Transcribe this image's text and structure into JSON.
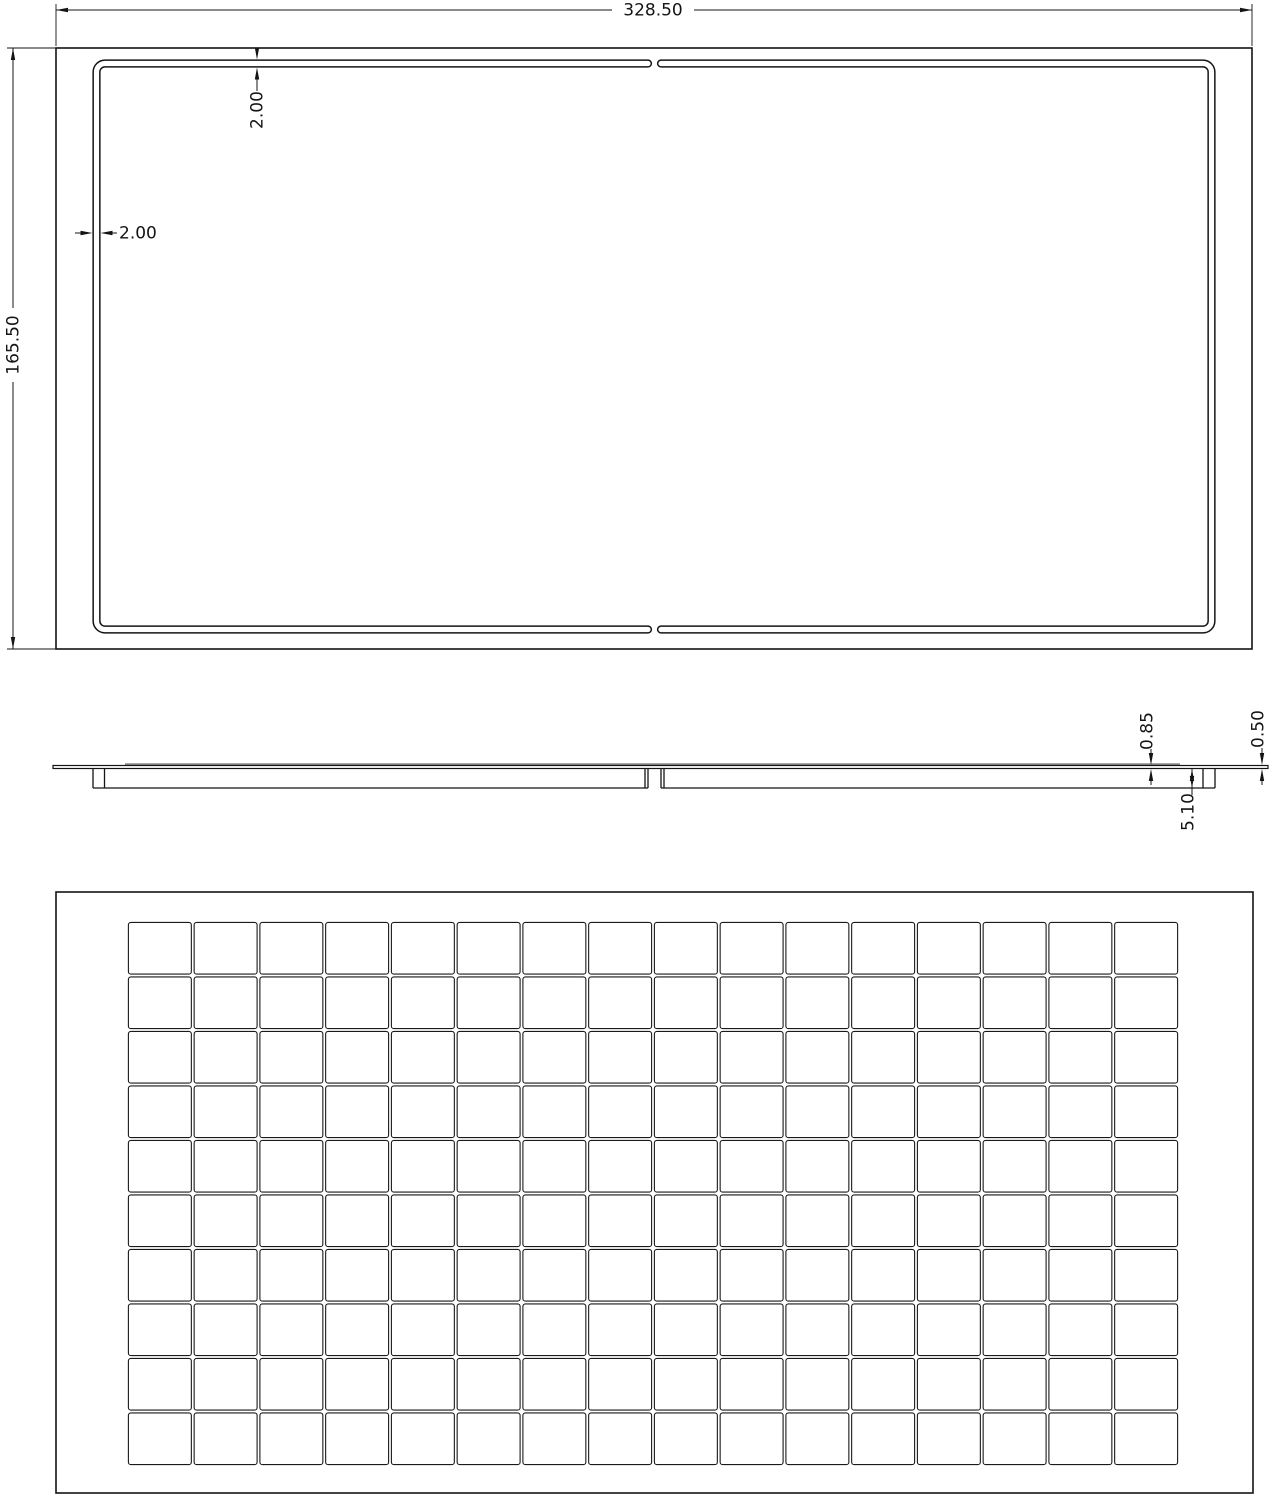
{
  "colors": {
    "line": "#141414",
    "gray_band": "#8a8a8a",
    "background": "#ffffff",
    "cell_line": "#1a1a1a"
  },
  "top_view": {
    "width_dim": "328.50",
    "height_dim": "165.50",
    "groove_width_dim_top": "2.00",
    "groove_width_dim_left": "2.00"
  },
  "side_view": {
    "sheet_thickness_dim": "0.85",
    "rib_depth_dim": "5.10",
    "edge_thickness_dim": "0.50"
  },
  "grid_view": {
    "columns": 16,
    "rows": 10
  }
}
